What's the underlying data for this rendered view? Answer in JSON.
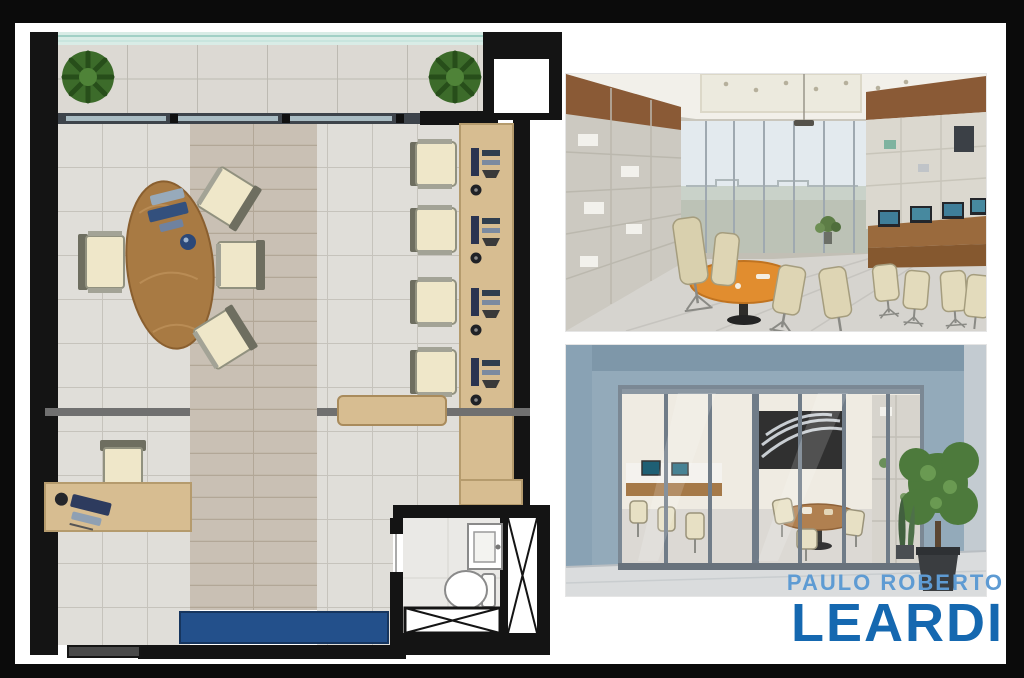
{
  "brand": {
    "top_line": "PAULO ROBERTO",
    "bottom_line": "LEARDI",
    "top_color": "#5e9bd3",
    "bottom_color": "#1568b0"
  },
  "panels": {
    "floor_plan": {
      "label": "office floor plan",
      "features": [
        "terrace with two plants",
        "glass facade",
        "elevator shaft",
        "oval wood meeting table with four chairs",
        "four workstations on right wall desk",
        "manager desk with computer",
        "sideboard",
        "blue bench",
        "bathroom with sink and toilet",
        "service shaft"
      ]
    },
    "photo_top": {
      "label": "office interior render"
    },
    "photo_bottom": {
      "label": "office entrance render"
    }
  },
  "palette": {
    "frame": "#0b0b0b",
    "canvas": "#ffffff",
    "wall_black": "#141414",
    "tile_gray": "#e0ded9",
    "plank_taupe": "#c9c0b4",
    "desk_wood": "#d7bd91",
    "table_wood": "#a87a43",
    "chair_cream": "#efe7c9",
    "bench_blue": "#23508b",
    "terrace_glass": "#d9ece6",
    "facade_blue_gray": "#93aaba",
    "render_table_orange": "#e18d2f"
  }
}
